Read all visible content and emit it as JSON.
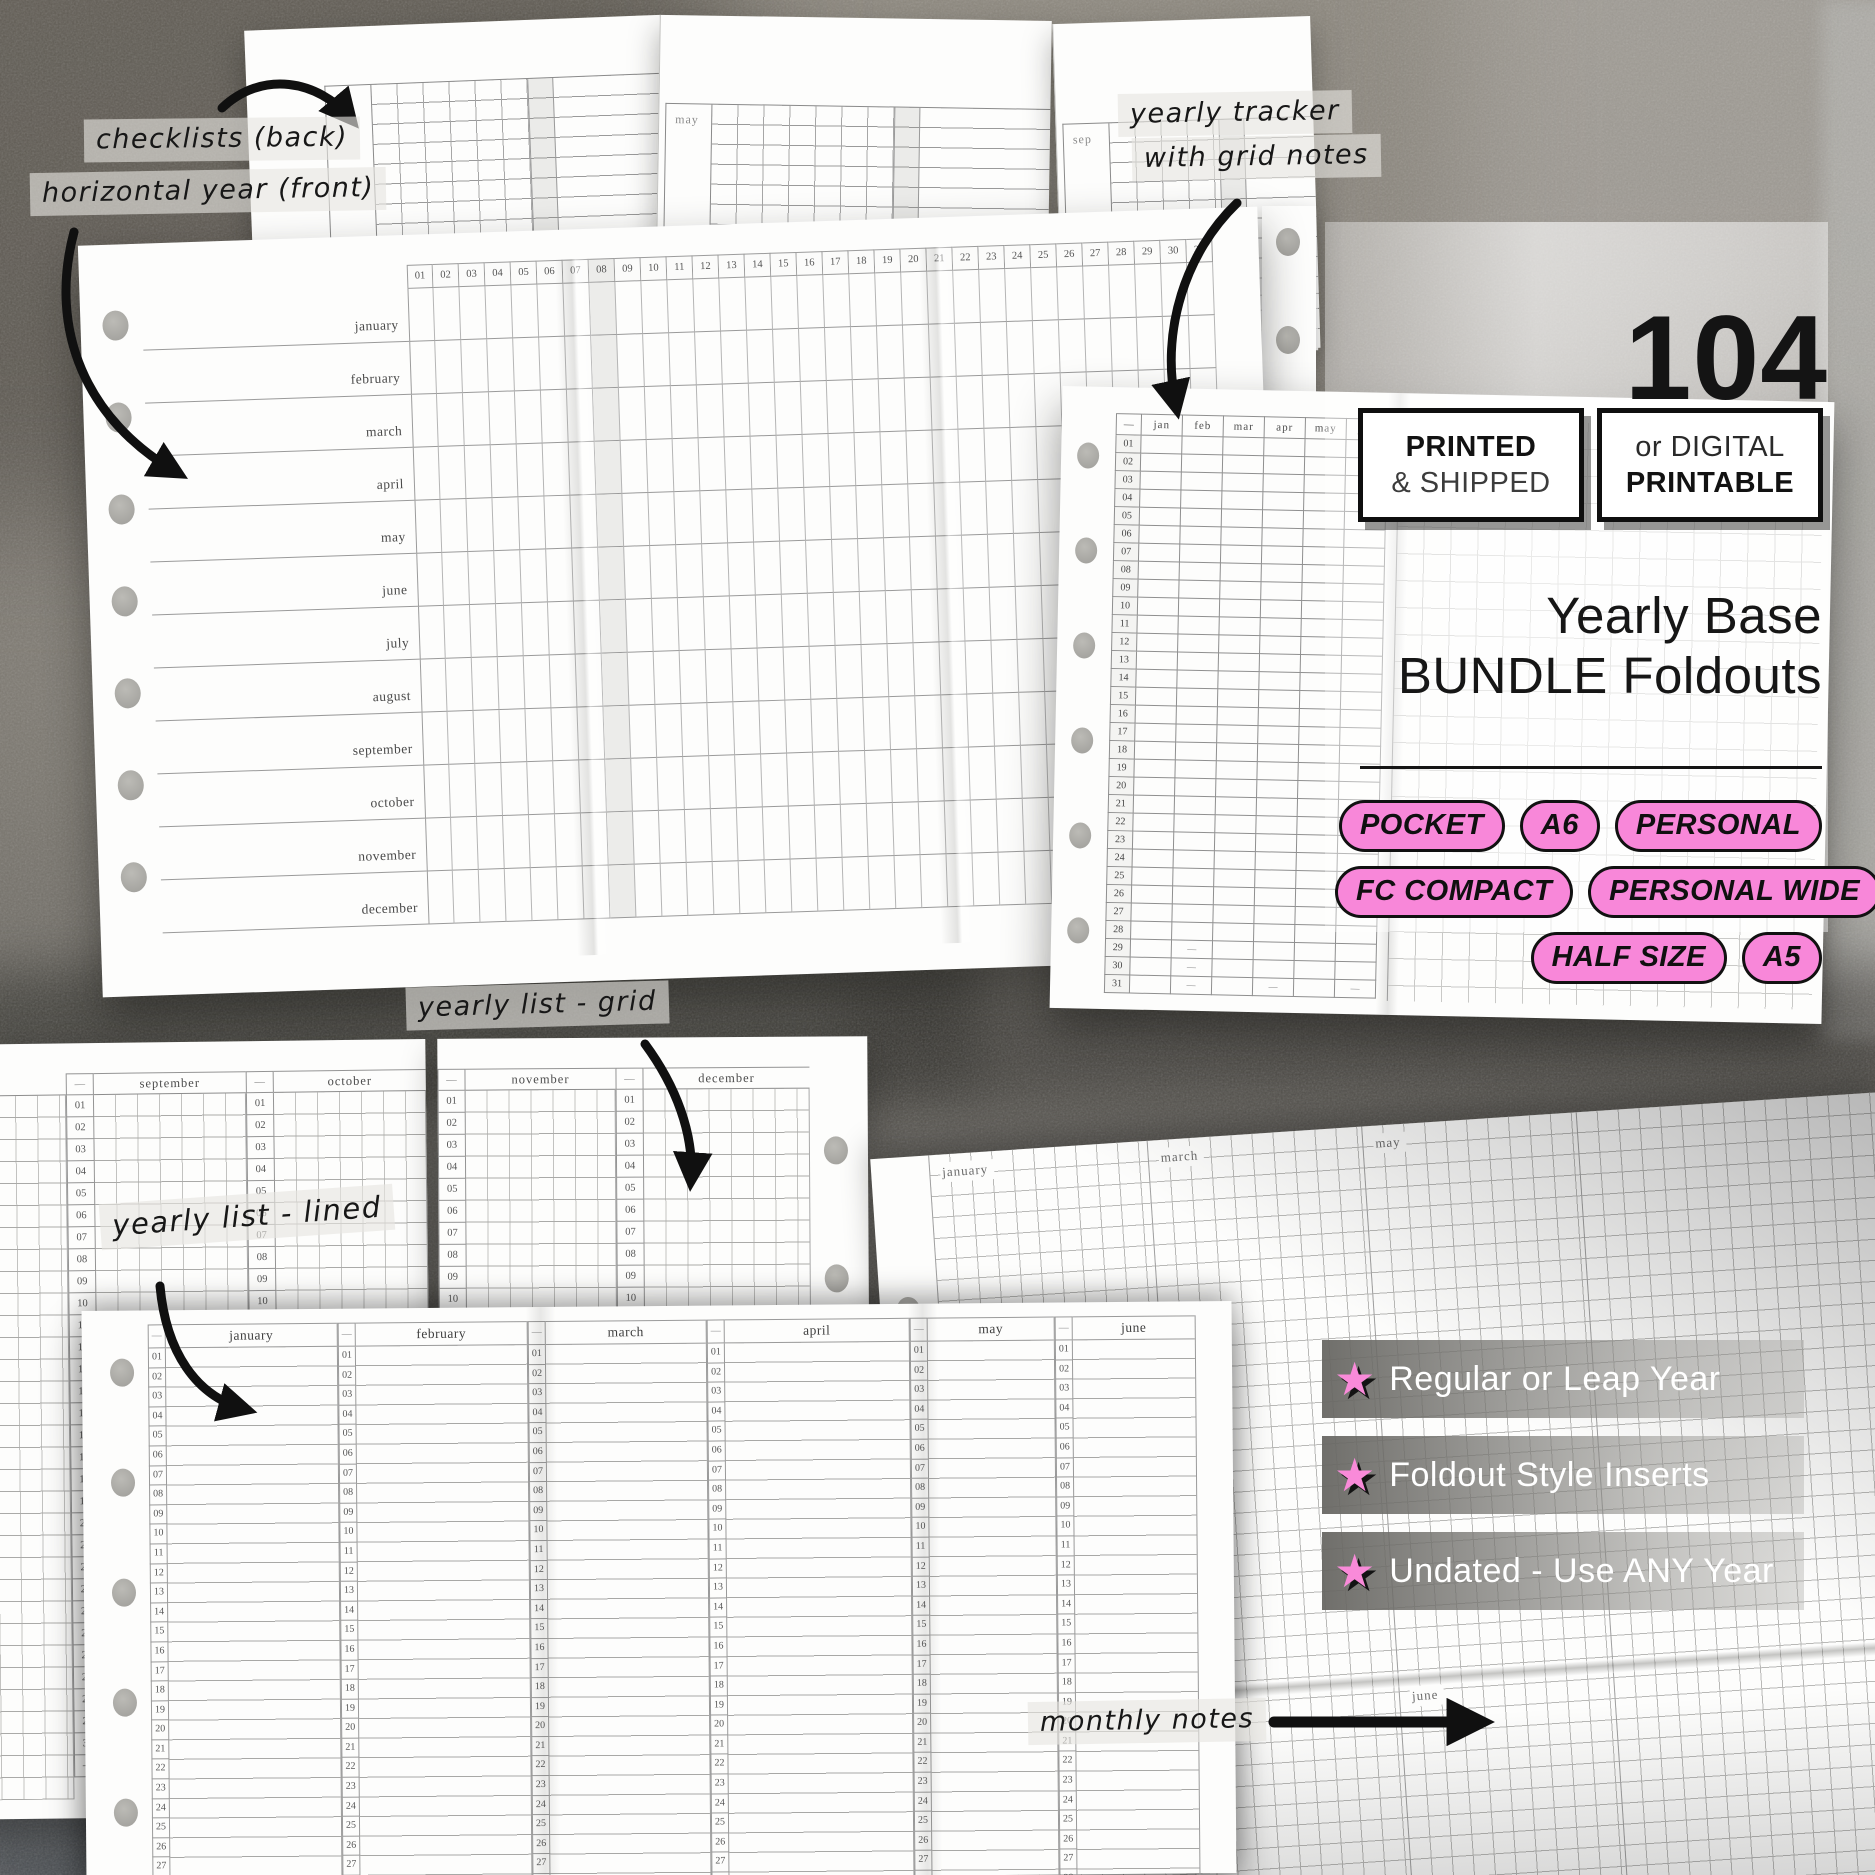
{
  "annotations": {
    "checklists": "checklists (back)",
    "horizontal_year": "horizontal year (front)",
    "tracker_line1": "yearly tracker",
    "tracker_line2": "with grid notes",
    "grid_list": "yearly list - grid",
    "lined_list": "yearly list - lined",
    "monthly_notes": "monthly notes"
  },
  "info": {
    "count": "104",
    "badge_printed": {
      "line1": "PRINTED",
      "line2": "& SHIPPED"
    },
    "badge_digital": {
      "line1": "or DIGITAL",
      "line2": "PRINTABLE"
    },
    "title_line1": "Yearly Base",
    "title_line2": "BUNDLE Foldouts",
    "sizes": [
      [
        "POCKET",
        "A6",
        "PERSONAL"
      ],
      [
        "FC COMPACT",
        "PERSONAL WIDE"
      ],
      [
        "HALF SIZE",
        "A5"
      ]
    ],
    "features": [
      "Regular or Leap Year",
      "Foldout Style Inserts",
      "Undated - Use ANY Year"
    ],
    "star": "★"
  },
  "colors": {
    "pink": "#f887d9",
    "ink": "#141414"
  },
  "day_numbers": [
    "01",
    "02",
    "03",
    "04",
    "05",
    "06",
    "07",
    "08",
    "09",
    "10",
    "11",
    "12",
    "13",
    "14",
    "15",
    "16",
    "17",
    "18",
    "19",
    "20",
    "21",
    "22",
    "23",
    "24",
    "25",
    "26",
    "27",
    "28",
    "29",
    "30",
    "31"
  ],
  "mockups": {
    "checklist_back": {
      "panels": [
        [
          "jan",
          "feb"
        ],
        [
          "may",
          "jun"
        ],
        [
          "sep",
          "oct"
        ]
      ]
    },
    "horizontal_year": {
      "months": [
        "january",
        "february",
        "march",
        "april",
        "may",
        "june",
        "july",
        "august",
        "september",
        "october",
        "november",
        "december"
      ]
    },
    "tracker": {
      "columns": [
        "—",
        "jan",
        "feb",
        "mar",
        "apr",
        "may",
        "jun"
      ],
      "dash": "—",
      "no_day": {
        "feb": [
          29,
          30,
          31
        ],
        "apr": [
          31
        ],
        "jun": [
          31
        ]
      }
    },
    "grid_list": {
      "months": [
        "september",
        "october",
        "november",
        "december"
      ],
      "corner": "—"
    },
    "lined_list": {
      "months": [
        "january",
        "february",
        "march",
        "april",
        "may",
        "june"
      ],
      "corner": "—",
      "visible_rows": 27
    },
    "monthly_notes": {
      "top": [
        "january",
        "march",
        "may"
      ],
      "bottom": [
        "april",
        "june"
      ]
    }
  }
}
